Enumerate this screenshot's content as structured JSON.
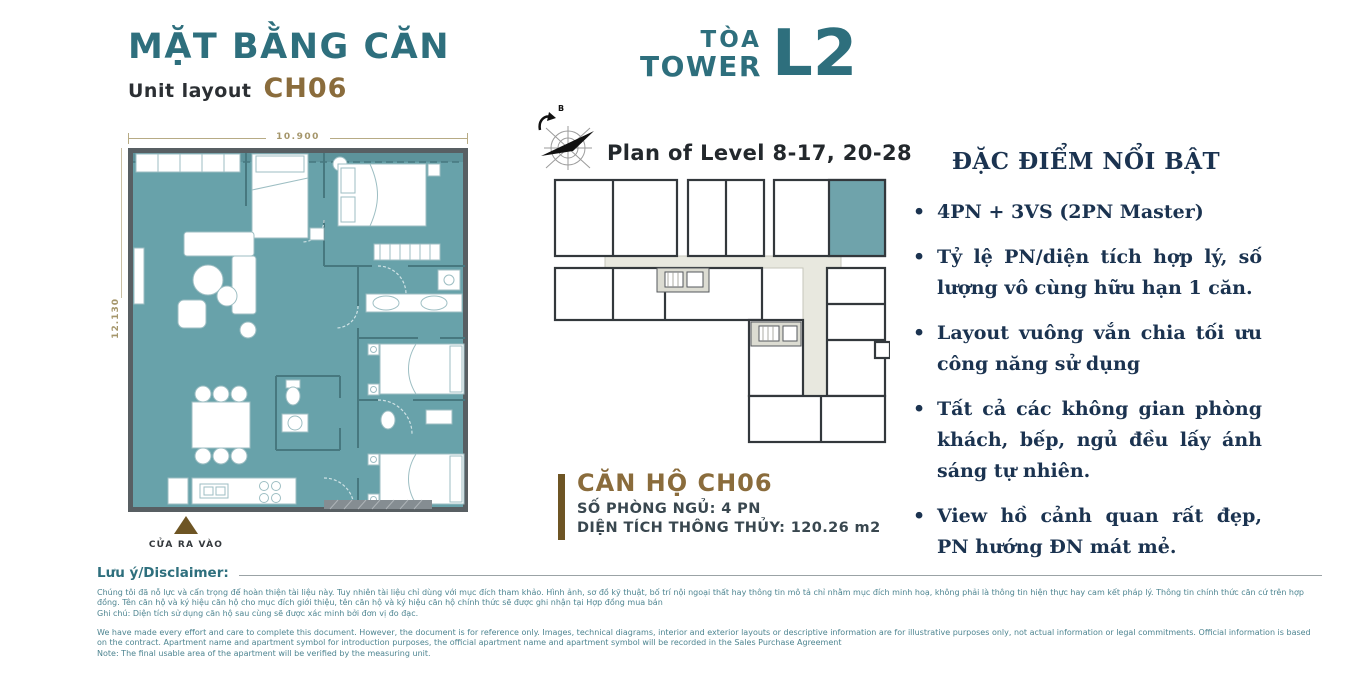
{
  "title_block": {
    "title": "MẶT BẰNG CĂN",
    "subtitle": "Unit layout",
    "unit_code": "CH06"
  },
  "tower": {
    "line1": "TÒA",
    "line2": "TOWER",
    "code": "L2"
  },
  "floor_plan": {
    "dim_top": "10.900",
    "dim_left": "12.130",
    "entrance_label": "CỬA RA VÀO"
  },
  "key_plan": {
    "title": "Plan of Level 8-17, 20-28",
    "compass_label": "B"
  },
  "unit_info": {
    "name": "CĂN HỘ CH06",
    "bedrooms": "SỐ PHÒNG NGỦ: 4 PN",
    "area": "DIỆN TÍCH THÔNG THỦY: 120.26 m2"
  },
  "features": {
    "heading": "ĐẶC ĐIỂM NỔI BẬT",
    "items": [
      "4PN + 3VS (2PN Master)",
      "Tỷ lệ PN/diện tích hợp lý, số lượng vô cùng hữu hạn 1 căn.",
      "Layout vuông vắn chia tối ưu công năng sử dụng",
      "Tất cả các không gian phòng khách, bếp, ngủ đều lấy ánh sáng tự nhiên.",
      "View hồ cảnh quan rất đẹp, PN hướng ĐN mát mẻ."
    ]
  },
  "disclaimer": {
    "heading": "Lưu ý/Disclaimer:",
    "vi": "Chúng tôi đã nỗ lực và cẩn trọng để hoàn thiện tài liệu này. Tuy nhiên tài liệu chỉ dùng với mục đích tham khảo. Hình ảnh, sơ đồ kỹ thuật, bố trí nội ngoại thất hay thông tin mô tả chỉ nhằm mục đích minh hoạ, không phải là thông tin hiện thực hay cam kết pháp lý. Thông tin chính thức căn cứ trên hợp đồng. Tên căn hộ và ký hiệu căn hộ cho mục đích giới thiệu, tên căn hộ và ký hiệu căn hộ chính thức sẽ được ghi nhận tại Hợp đồng mua bán",
    "vi_note": "Ghi chú: Diện tích sử dụng căn hộ sau cùng sẽ được xác minh bởi đơn vị đo đạc.",
    "en": "We have made every effort and care to complete this document. However, the document is for reference only. Images, technical diagrams, interior and exterior layouts or descriptive information are for illustrative purposes only, not actual information or legal commitments. Official information is based on the contract. Apartment name and apartment symbol for introduction purposes, the official apartment name and apartment symbol will be recorded in the Sales Purchase Agreement",
    "en_note": "Note: The final usable area of the apartment will be verified by the measuring unit."
  },
  "colors": {
    "teal_heading": "#2E6F7D",
    "brown_accent": "#8A6C3C",
    "brown_dark": "#6E5524",
    "navy_text": "#1B3350",
    "plan_fill": "#68A2AA",
    "wall": "#585F63",
    "corridor": "#E8E8DF",
    "disclaimer_text": "#4E8591"
  }
}
